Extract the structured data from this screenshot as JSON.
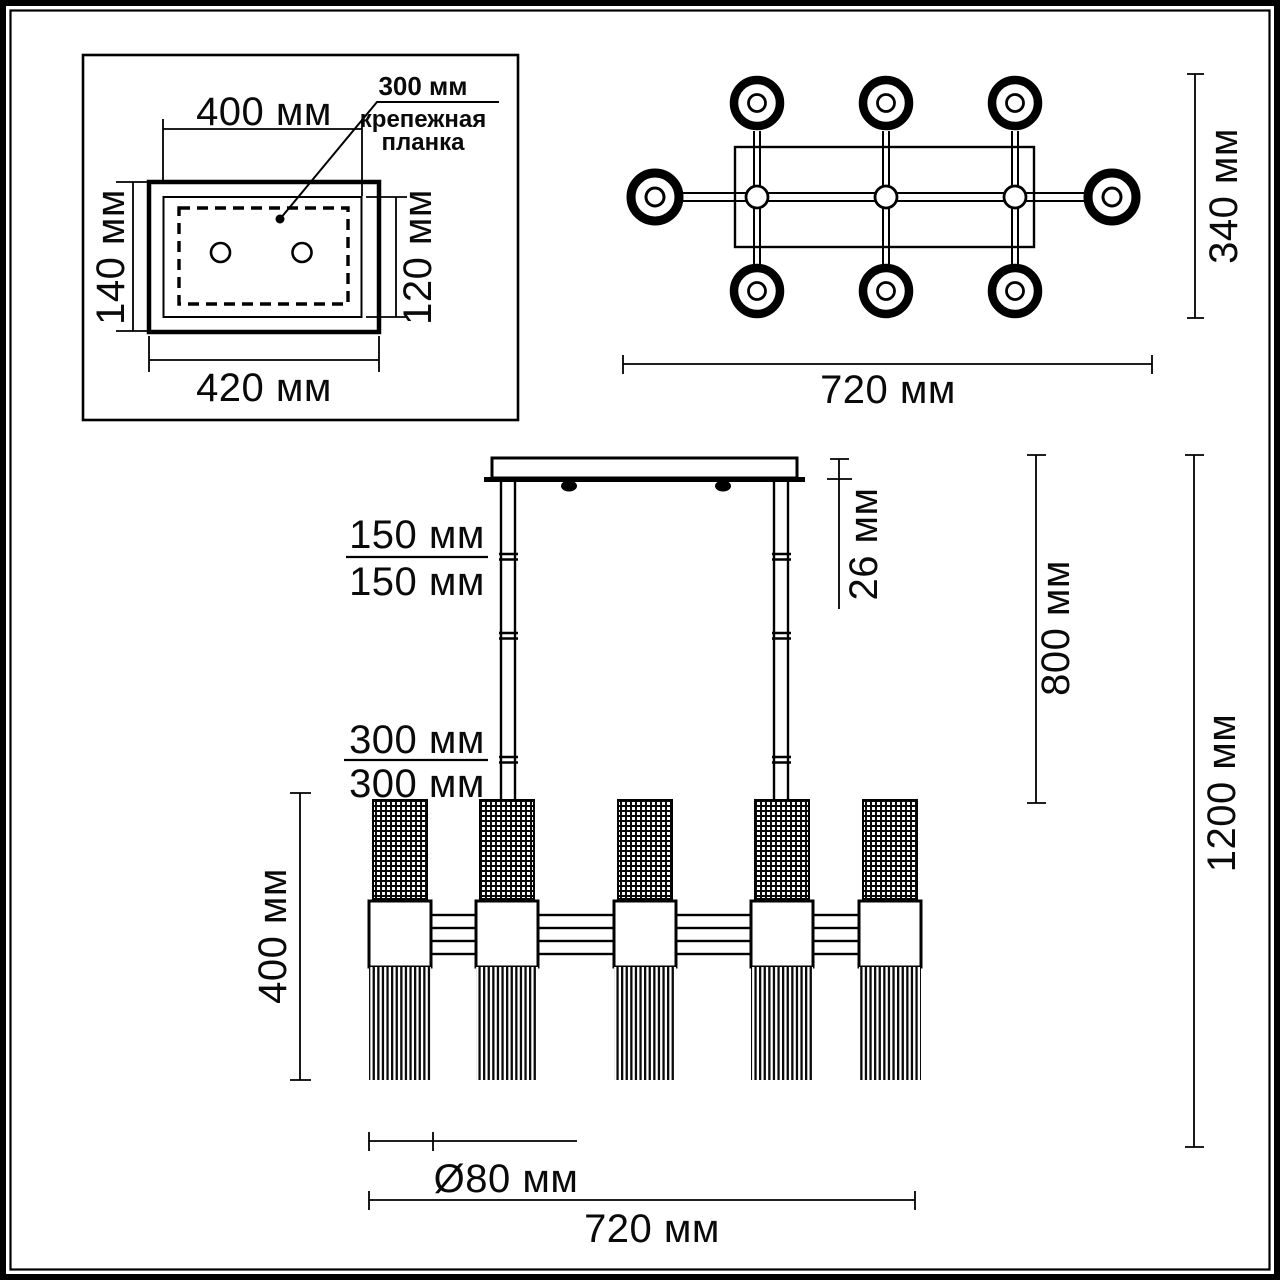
{
  "drawing": {
    "units": "мм",
    "mount_plate": {
      "top_width": "400 мм",
      "bottom_width": "420 мм",
      "left_height": "140 мм",
      "right_height": "120 мм",
      "bracket_size": "300 мм",
      "bracket_name_line1": "крепежная",
      "bracket_name_line2": "планка"
    },
    "top_view": {
      "width": "720 мм",
      "depth": "340 мм"
    },
    "front_view": {
      "rod_segment_1": "150 мм",
      "rod_segment_2": "150 мм",
      "rod_segment_3": "300 мм",
      "rod_segment_4": "300 мм",
      "canopy_height": "26 мм",
      "suspension_height": "800 мм",
      "total_height": "1200 мм",
      "lamp_height": "400 мм",
      "shade_diameter": "Ø80 мм",
      "width": "720 мм"
    }
  }
}
